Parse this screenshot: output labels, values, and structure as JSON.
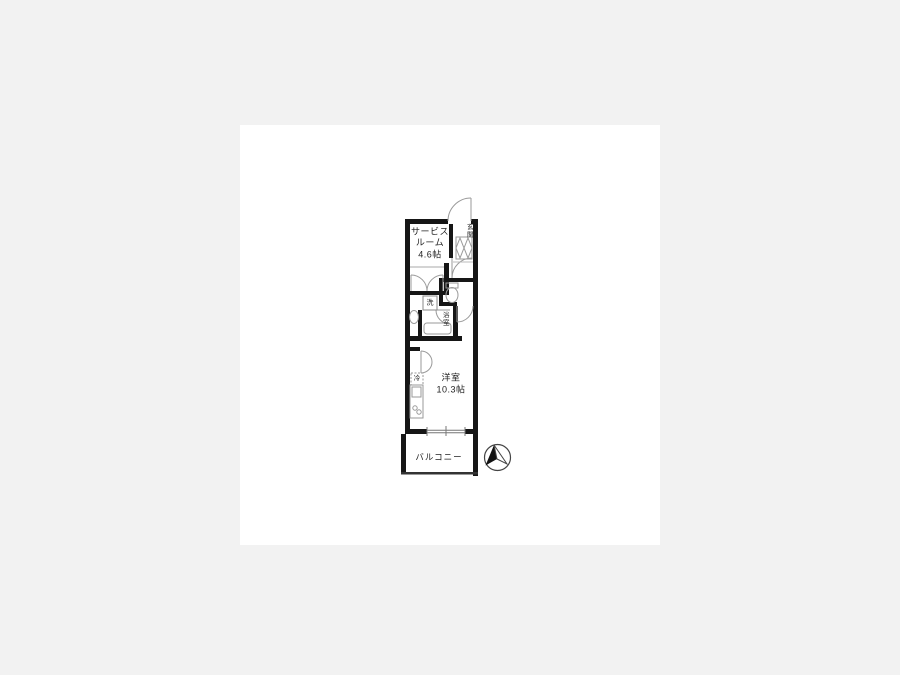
{
  "colors": {
    "background": "#f2f2f2",
    "card": "#ffffff",
    "wall": "#161616",
    "line": "#999999",
    "text": "#222222"
  },
  "floorplan": {
    "labels": {
      "entrance": "玄関",
      "service_room_line1": "サービス",
      "service_room_line2": "ルーム",
      "service_room_size": "4.6帖",
      "laundry": "洗",
      "bathroom": "浴室",
      "refrigerator": "冷",
      "western_room": "洋室",
      "western_room_size": "10.3帖",
      "balcony": "バルコニー"
    },
    "icons": {
      "compass": "north-arrow"
    }
  }
}
